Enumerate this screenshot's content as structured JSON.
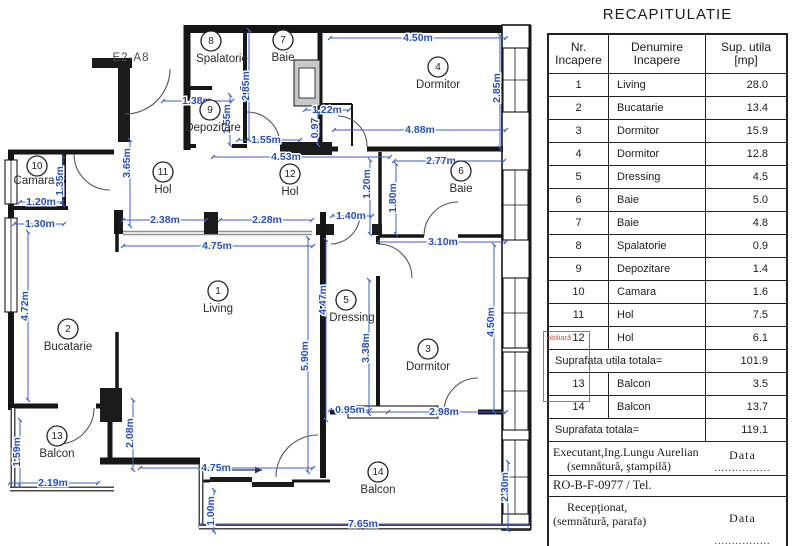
{
  "plan": {
    "unit_code": "E2-A8",
    "rooms": [
      {
        "num": "1",
        "name": "Living",
        "cx": 218,
        "cy": 291,
        "nx": 218,
        "ny": 309
      },
      {
        "num": "2",
        "name": "Bucatarie",
        "cx": 68,
        "cy": 329,
        "nx": 68,
        "ny": 347
      },
      {
        "num": "3",
        "name": "Dormitor",
        "cx": 428,
        "cy": 349,
        "nx": 428,
        "ny": 367
      },
      {
        "num": "4",
        "name": "Dormitor",
        "cx": 438,
        "cy": 67,
        "nx": 438,
        "ny": 85
      },
      {
        "num": "5",
        "name": "Dressing",
        "cx": 346,
        "cy": 300,
        "nx": 352,
        "ny": 318
      },
      {
        "num": "6",
        "name": "Baie",
        "cx": 461,
        "cy": 171,
        "nx": 461,
        "ny": 189
      },
      {
        "num": "7",
        "name": "Baie",
        "cx": 283,
        "cy": 40,
        "nx": 283,
        "ny": 58
      },
      {
        "num": "8",
        "name": "Spalatorie",
        "cx": 211,
        "cy": 41,
        "nx": 222,
        "ny": 59
      },
      {
        "num": "9",
        "name": "Depozitare",
        "cx": 210,
        "cy": 110,
        "nx": 213,
        "ny": 128
      },
      {
        "num": "10",
        "name": "Camara",
        "cx": 37,
        "cy": 166,
        "nx": 34,
        "ny": 181
      },
      {
        "num": "11",
        "name": "Hol",
        "cx": 163,
        "cy": 172,
        "nx": 163,
        "ny": 190
      },
      {
        "num": "12",
        "name": "Hol",
        "cx": 290,
        "cy": 174,
        "nx": 290,
        "ny": 192
      },
      {
        "num": "13",
        "name": "Balcon",
        "cx": 57,
        "cy": 436,
        "nx": 57,
        "ny": 454
      },
      {
        "num": "14",
        "name": "Balcon",
        "cx": 378,
        "cy": 472,
        "nx": 378,
        "ny": 490
      }
    ],
    "dims": [
      {
        "t": "4.50m",
        "x1": 330,
        "y1": 38,
        "x2": 506,
        "y2": 38,
        "lx": 418,
        "ly": 38,
        "rot": 0
      },
      {
        "t": "1.38m",
        "x1": 163,
        "y1": 101,
        "x2": 232,
        "y2": 101,
        "lx": 197,
        "ly": 101,
        "rot": 0
      },
      {
        "t": "1.55m",
        "x1": 238,
        "y1": 140,
        "x2": 300,
        "y2": 140,
        "lx": 266,
        "ly": 140,
        "rot": 0
      },
      {
        "t": "4.53m",
        "x1": 213,
        "y1": 157,
        "x2": 390,
        "y2": 157,
        "lx": 286,
        "ly": 157,
        "rot": 0
      },
      {
        "t": "1.22m",
        "x1": 305,
        "y1": 110,
        "x2": 349,
        "y2": 110,
        "lx": 327,
        "ly": 110,
        "rot": 0
      },
      {
        "t": "4.88m",
        "x1": 334,
        "y1": 130,
        "x2": 506,
        "y2": 130,
        "lx": 420,
        "ly": 130,
        "rot": 0
      },
      {
        "t": "2.77m",
        "x1": 394,
        "y1": 161,
        "x2": 504,
        "y2": 161,
        "lx": 441,
        "ly": 161,
        "rot": 0
      },
      {
        "t": "3.10m",
        "x1": 378,
        "y1": 242,
        "x2": 506,
        "y2": 242,
        "lx": 443,
        "ly": 242,
        "rot": 0
      },
      {
        "t": "1.40m",
        "x1": 332,
        "y1": 216,
        "x2": 372,
        "y2": 216,
        "lx": 351,
        "ly": 216,
        "rot": 0
      },
      {
        "t": "2.38m",
        "x1": 123,
        "y1": 220,
        "x2": 206,
        "y2": 220,
        "lx": 165,
        "ly": 220,
        "rot": 0
      },
      {
        "t": "2.28m",
        "x1": 220,
        "y1": 220,
        "x2": 312,
        "y2": 220,
        "lx": 267,
        "ly": 220,
        "rot": 0
      },
      {
        "t": "4.75m",
        "x1": 123,
        "y1": 246,
        "x2": 313,
        "y2": 246,
        "lx": 217,
        "ly": 246,
        "rot": 0
      },
      {
        "t": "1.20m",
        "x1": 20,
        "y1": 202,
        "x2": 62,
        "y2": 202,
        "lx": 41,
        "ly": 202,
        "rot": 0
      },
      {
        "t": "1.30m",
        "x1": 14,
        "y1": 224,
        "x2": 64,
        "y2": 224,
        "lx": 40,
        "ly": 224,
        "rot": 0
      },
      {
        "t": "2.19m",
        "x1": 10,
        "y1": 483,
        "x2": 98,
        "y2": 483,
        "lx": 53,
        "ly": 483,
        "rot": 0
      },
      {
        "t": "0.95m",
        "x1": 330,
        "y1": 410,
        "x2": 370,
        "y2": 410,
        "lx": 350,
        "ly": 410,
        "rot": 0
      },
      {
        "t": "2.98m",
        "x1": 388,
        "y1": 412,
        "x2": 506,
        "y2": 412,
        "lx": 444,
        "ly": 412,
        "rot": 0
      },
      {
        "t": "4.75m",
        "x1": 140,
        "y1": 468,
        "x2": 313,
        "y2": 468,
        "lx": 216,
        "ly": 468,
        "rot": 0
      },
      {
        "t": "7.65m",
        "x1": 201,
        "y1": 524,
        "x2": 528,
        "y2": 524,
        "lx": 363,
        "ly": 524,
        "rot": 0
      },
      {
        "t": "2.85m",
        "x1": 500,
        "y1": 35,
        "x2": 500,
        "y2": 148,
        "lx": 497,
        "ly": 88,
        "rot": -90
      },
      {
        "t": "2.85m",
        "x1": 249,
        "y1": 30,
        "x2": 249,
        "y2": 140,
        "lx": 246,
        "ly": 86,
        "rot": -90
      },
      {
        "t": "1.55m",
        "x1": 230,
        "y1": 95,
        "x2": 230,
        "y2": 145,
        "lx": 227,
        "ly": 119,
        "rot": -90
      },
      {
        "t": "0.97",
        "x1": 318,
        "y1": 112,
        "x2": 318,
        "y2": 145,
        "lx": 315,
        "ly": 128,
        "rot": -90
      },
      {
        "t": "3.65m",
        "x1": 130,
        "y1": 140,
        "x2": 130,
        "y2": 226,
        "lx": 127,
        "ly": 163,
        "rot": -90
      },
      {
        "t": "1.35m",
        "x1": 63,
        "y1": 156,
        "x2": 63,
        "y2": 205,
        "lx": 60,
        "ly": 181,
        "rot": -90
      },
      {
        "t": "1.20m",
        "x1": 370,
        "y1": 160,
        "x2": 370,
        "y2": 234,
        "lx": 367,
        "ly": 184,
        "rot": -90
      },
      {
        "t": "1.80m",
        "x1": 396,
        "y1": 164,
        "x2": 396,
        "y2": 234,
        "lx": 393,
        "ly": 198,
        "rot": -90
      },
      {
        "t": "4.72m",
        "x1": 28,
        "y1": 232,
        "x2": 28,
        "y2": 400,
        "lx": 25,
        "ly": 306,
        "rot": -90
      },
      {
        "t": "5.90m",
        "x1": 308,
        "y1": 238,
        "x2": 308,
        "y2": 472,
        "lx": 305,
        "ly": 356,
        "rot": -90
      },
      {
        "t": "4.47m",
        "x1": 326,
        "y1": 240,
        "x2": 326,
        "y2": 420,
        "lx": 323,
        "ly": 300,
        "rot": -90
      },
      {
        "t": "3.38m",
        "x1": 369,
        "y1": 280,
        "x2": 369,
        "y2": 414,
        "lx": 366,
        "ly": 348,
        "rot": -90
      },
      {
        "t": "4.50m",
        "x1": 494,
        "y1": 245,
        "x2": 494,
        "y2": 412,
        "lx": 491,
        "ly": 322,
        "rot": -90
      },
      {
        "t": "2.08m",
        "x1": 133,
        "y1": 400,
        "x2": 133,
        "y2": 470,
        "lx": 130,
        "ly": 433,
        "rot": -90
      },
      {
        "t": "1.59m",
        "x1": 20,
        "y1": 420,
        "x2": 20,
        "y2": 486,
        "lx": 17,
        "ly": 452,
        "rot": -90
      },
      {
        "t": "1.00m",
        "x1": 214,
        "y1": 490,
        "x2": 214,
        "y2": 532,
        "lx": 211,
        "ly": 511,
        "rot": -90
      },
      {
        "t": "2.30m",
        "x1": 508,
        "y1": 462,
        "x2": 508,
        "y2": 530,
        "lx": 505,
        "ly": 487,
        "rot": -90
      }
    ]
  },
  "stamp": {
    "text": "obiliară"
  },
  "table": {
    "title": "RECAPITULATIE",
    "headers": [
      [
        "Nr.",
        "Incapere"
      ],
      [
        "Denumire",
        "Incapere"
      ],
      [
        "Sup. utila",
        "[mp]"
      ]
    ],
    "rows": [
      [
        "1",
        "Living",
        "28.0"
      ],
      [
        "2",
        "Bucatarie",
        "13.4"
      ],
      [
        "3",
        "Dormitor",
        "15.9"
      ],
      [
        "4",
        "Dormitor",
        "12.8"
      ],
      [
        "5",
        "Dressing",
        "4.5"
      ],
      [
        "6",
        "Baie",
        "5.0"
      ],
      [
        "7",
        "Baie",
        "4.8"
      ],
      [
        "8",
        "Spalatorie",
        "0.9"
      ],
      [
        "9",
        "Depozitare",
        "1.4"
      ],
      [
        "10",
        "Camara",
        "1.6"
      ],
      [
        "11",
        "Hol",
        "7.5"
      ],
      [
        "12",
        "Hol",
        "6.1"
      ]
    ],
    "subtotal_label": "Suprafata utila totala=",
    "subtotal_value": "101.9",
    "balcony_rows": [
      [
        "13",
        "Balcon",
        "3.5"
      ],
      [
        "14",
        "Balcon",
        "13.7"
      ]
    ],
    "total_label": "Suprafata totala=",
    "total_value": "119.1",
    "executant_line1": "Executant,Ing.Lungu Aurelian",
    "executant_line2": "(semnătură, ştampilă)",
    "data_label": "Data",
    "dots": "................",
    "ro_line": "RO-B-F-0977 / Tel.",
    "receptionat_line1": "Recepţionat,",
    "receptionat_line2": "(semnătură, parafa)"
  },
  "colors": {
    "dim_blue": "#2750c0",
    "wall_black": "#161616",
    "stamp_red": "#c6342d"
  }
}
